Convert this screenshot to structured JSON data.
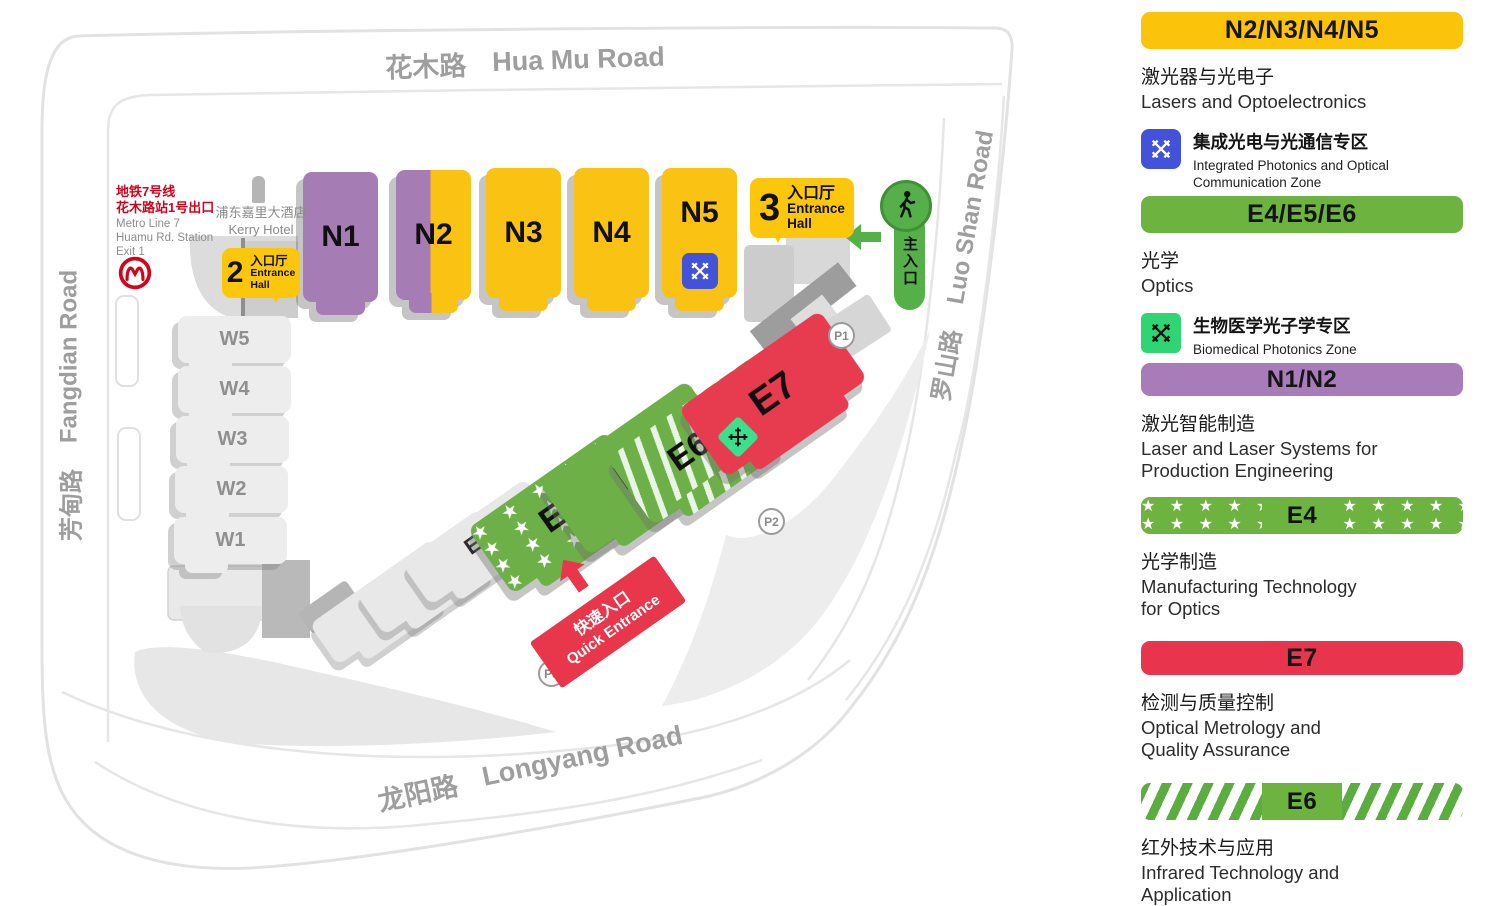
{
  "colors": {
    "yellow": "#FCC30B",
    "purple": "#A77CB8",
    "green": "#6CB33F",
    "red": "#E8354D",
    "blue_zone": "#4353D9",
    "bright_green_zone": "#2ED573"
  },
  "legend": {
    "groups": [
      {
        "badge": "N2/N3/N4/N5",
        "zh": "激光器与光电子",
        "en1": "Lasers and Optoelectronics",
        "en2": ""
      },
      {
        "badge": "E4/E5/E6",
        "zh": "光学",
        "en1": "Optics",
        "en2": ""
      },
      {
        "badge": "N1/N2",
        "zh": "激光智能制造",
        "en1": "Laser and Laser Systems for",
        "en2": "Production Engineering"
      },
      {
        "badge": "E4",
        "zh": "光学制造",
        "en1": "Manufacturing Technology",
        "en2": "for Optics"
      },
      {
        "badge": "E7",
        "zh": "检测与质量控制",
        "en1": "Optical Metrology and",
        "en2": "Quality Assurance"
      },
      {
        "badge": "E6",
        "zh": "红外技术与应用",
        "en1": "Infrared Technology and",
        "en2": "Application"
      }
    ],
    "subzones": [
      {
        "zh": "集成光电与光通信专区",
        "en1": "Integrated Photonics and Optical",
        "en2": "Communication Zone"
      },
      {
        "zh": "生物医学光子学专区",
        "en1": "Biomedical Photonics Zone",
        "en2": ""
      }
    ]
  },
  "map": {
    "roads": {
      "huamu_zh": "花木路",
      "huamu_en": "Hua Mu Road",
      "fangdian_zh": "芳甸路",
      "fangdian_en": "Fangdian Road",
      "luoshan_zh": "罗山路",
      "luoshan_en": "Luo Shan Road",
      "longyang_zh": "龙阳路",
      "longyang_en": "Longyang Road"
    },
    "metro": {
      "zh1": "地铁7号线",
      "zh2": "花木路站1号出口",
      "en1": "Metro Line 7",
      "en2": "Huamu Rd. Station",
      "en3": "Exit 1"
    },
    "kerry_zh": "浦东嘉里大酒店",
    "kerry_en": "Kerry Hotel",
    "entrance2_num": "2",
    "entrance3_num": "3",
    "entrance_zh": "入口厅",
    "entrance_en1": "Entrance",
    "entrance_en2": "Hall",
    "main_entrance_zh": "主入口",
    "quick_zh": "快速入口",
    "quick_en": "Quick Entrance",
    "halls": {
      "n1": "N1",
      "n2": "N2",
      "n3": "N3",
      "n4": "N4",
      "n5": "N5",
      "w1": "W1",
      "w2": "W2",
      "w3": "W3",
      "w4": "W4",
      "w5": "W5",
      "e1": "E1",
      "e2": "E2",
      "e3": "E3",
      "e4": "E4",
      "e5": "E5",
      "e6": "E6",
      "e7": "E7"
    },
    "parking": {
      "p1": "P1",
      "p2": "P2",
      "p3": "P3"
    }
  }
}
